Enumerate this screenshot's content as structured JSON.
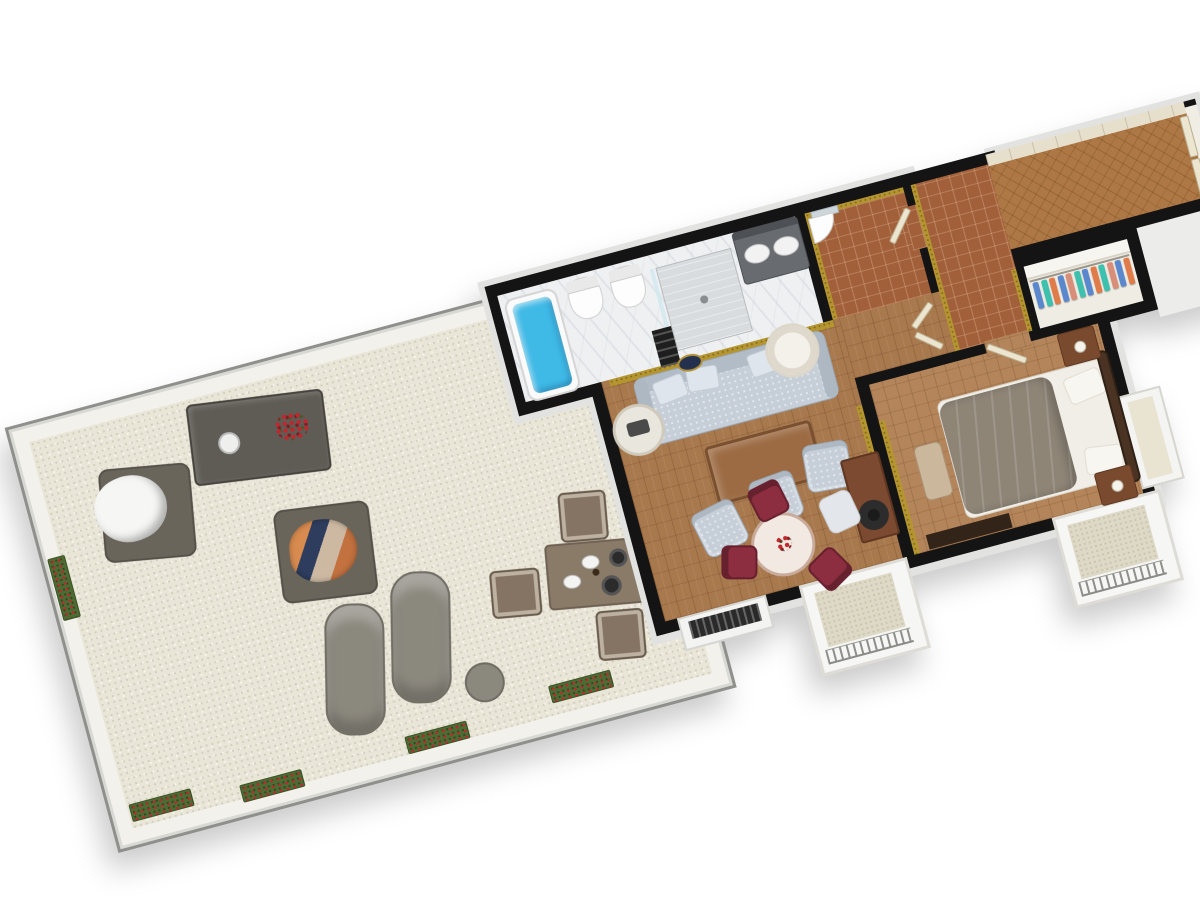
{
  "scene": {
    "title": "3D floor plan render of a suite with large terrace",
    "view": "rotated top-down 3D cutaway",
    "rotation_deg": -15,
    "background": "#ffffff"
  },
  "colors": {
    "wall": "#141414",
    "wallext": "#e2e2e0",
    "ext_face": "#ececea",
    "terrace_floor": "#e9e6d8",
    "terrace_wall": "#f2f1ec",
    "parquet": "#a9794e",
    "parquet2": "#b4855a",
    "herringbone": "#ad7845",
    "terracotta": "#a2603a",
    "marble": "#eef0f2",
    "closet_floor": "#efece4",
    "gold": "#b5952f",
    "water": "#3fb9e6",
    "sofa": "#c6cfd8",
    "red_chair": "#8c2e3f",
    "desk_wood": "#7c4a30",
    "coffee_wood": "#9c6b43",
    "duvet": "#8e8577",
    "headboard": "#4a3323",
    "nightstand": "#7a4a2e",
    "outdoor_dark": "#5f5c55",
    "outdoor_body": "#6a655b",
    "lounger": "#8b887e",
    "outdoor_table": "#8a7a68",
    "outdoor_chair": "#857463",
    "planter": "#4e6b33",
    "flower": "#c0272f",
    "balcony_floor": "#ded9c6",
    "radiator": "#2a2a2a",
    "bench": "#cbb79b",
    "tv": "#33241a",
    "cream_door": "#ece5cf",
    "cloth1": "#5b87cc",
    "cloth2": "#3ec0ae",
    "cloth3": "#e07b4a",
    "cloth4": "#d98e7a"
  },
  "terrace": {
    "name": "Terrace",
    "floor": "light gravel",
    "furniture": [
      "lounge chair with white blanket",
      "outdoor coffee table with red flower bouquet and bowl",
      "lounge chair with folded clothes",
      "sun lounger",
      "sun lounger",
      "round side table",
      "outdoor dining table with plates",
      "outdoor dining chair",
      "outdoor dining chair",
      "outdoor dining chair",
      "outdoor dining chair"
    ],
    "planter_count": 5
  },
  "rooms": {
    "bathroom": {
      "name": "Bathroom",
      "floor": "white marble",
      "items": [
        "bathtub with water",
        "toilet",
        "bidet",
        "walk-in shower",
        "double-sink vanity with mirror",
        "towel ladder"
      ]
    },
    "wc": {
      "name": "Guest WC",
      "floor": "terracotta tile",
      "walls": "gold damask wallpaper",
      "items": [
        "corner sink",
        "mirror"
      ]
    },
    "hallway": {
      "name": "Hallway",
      "floor": "terracotta tile",
      "walls": "gold damask wallpaper"
    },
    "corridor": {
      "name": "Entrance corridor",
      "floor": "herringbone parquet",
      "items": [
        "double entry door",
        "wainscot wall"
      ]
    },
    "closet": {
      "name": "Walk-in closet",
      "items": [
        "clothes rail with 12 hanging garments"
      ]
    },
    "living_room": {
      "name": "Living room",
      "floor": "parquet",
      "items": [
        "sofa with pillows",
        "round side table with tray",
        "drum table lamp",
        "gold wall medallion",
        "coffee table",
        "armchair",
        "armchair",
        "armchair",
        "writing desk",
        "black desk lamp",
        "desk chair",
        "round dining table with flowers",
        "red dining chair",
        "red dining chair",
        "red dining chair",
        "radiator under window"
      ]
    },
    "bedroom": {
      "name": "Bedroom",
      "floor": "parquet",
      "items": [
        "double bed with gray duvet",
        "ornate headboard",
        "nightstand",
        "nightstand",
        "bench",
        "TV cabinet",
        "window bay"
      ]
    }
  },
  "balcony_count": 2
}
